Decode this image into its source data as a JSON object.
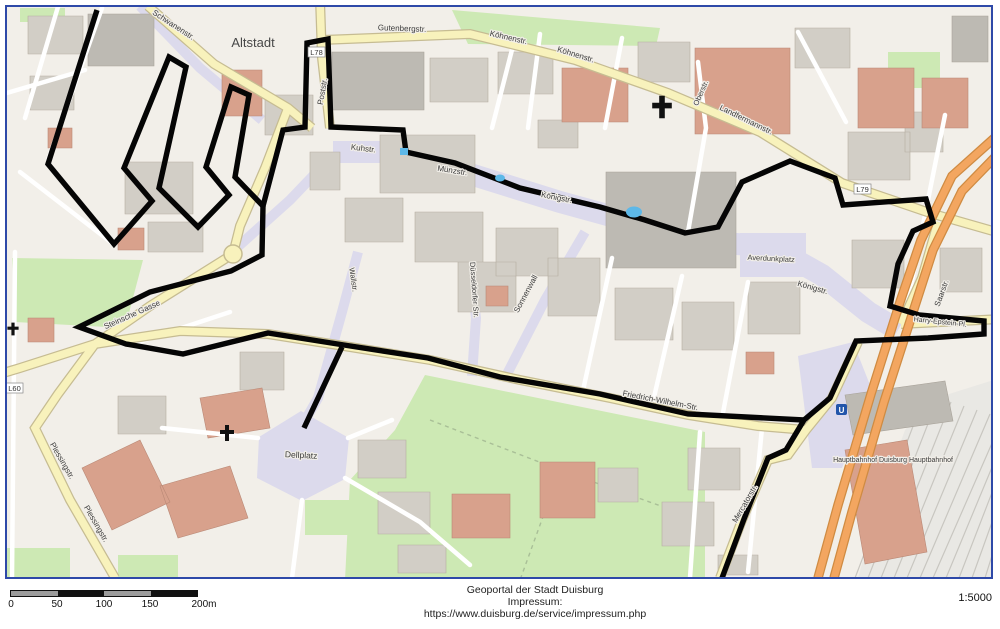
{
  "colors": {
    "frame_border": "#2e49a8",
    "boundary": "#050505",
    "road_yellow": "#f8f2bc",
    "road_orange": "#f3a660",
    "pedestrian_zone": "#dcdaec",
    "green_area": "#cde9b4",
    "building": "#d2cec6",
    "building_highlight": "#d8a18c",
    "water": "#5db8e8",
    "railway_bg": "#e9e8e4"
  },
  "map": {
    "place_labels": {
      "altstadt": "Altstadt",
      "dellplatz": "Dellplatz",
      "averdunkplatz": "Averdunkplatz",
      "harry_epstein": "Harry-Epstein-Pl.",
      "hauptbahnhof": "Hauptbahnhof Duisburg Hauptbahnhof"
    },
    "street_labels": {
      "schwanenstr": "Schwanenstr.",
      "poststr": "Poststr.",
      "gutenbergstr": "Gutenbergstr.",
      "koehnenstr_a": "Köhnenstr.",
      "koehnenstr_b": "Köhnenstr.",
      "oberstr": "Oberstr.",
      "landfermannstr": "Landfermannstr.",
      "kuhstr": "Kuhstr.",
      "muenzstr": "Münzstr.",
      "koenigstr_a": "Königstr.",
      "koenigstr_b": "Königstr.",
      "sonnenwall": "Sonnenwall",
      "duesseldorfer_str": "Düsseldorfer Str.",
      "wallstr": "Wallstr.",
      "friedrich_wilhelm_str": "Friedrich-Wilhelm-Str.",
      "steinsche_gasse": "Steinsche Gasse",
      "plessingstr_a": "Plessingstr.",
      "plessingstr_b": "Plessingstr.",
      "mercatorstr": "Mercatorstr.",
      "saarstr": "Saarstr."
    },
    "road_refs": {
      "l78": "L78",
      "l79": "L79",
      "l60": "L60"
    },
    "transit_letter": "U"
  },
  "scalebar": {
    "ticks": [
      "0",
      "50",
      "100",
      "150",
      "200m"
    ]
  },
  "footer": {
    "attribution": [
      "Geoportal der Stadt Duisburg",
      "Impressum:",
      "https://www.duisburg.de/service/impressum.php"
    ],
    "scale_ratio": "1:5000"
  }
}
